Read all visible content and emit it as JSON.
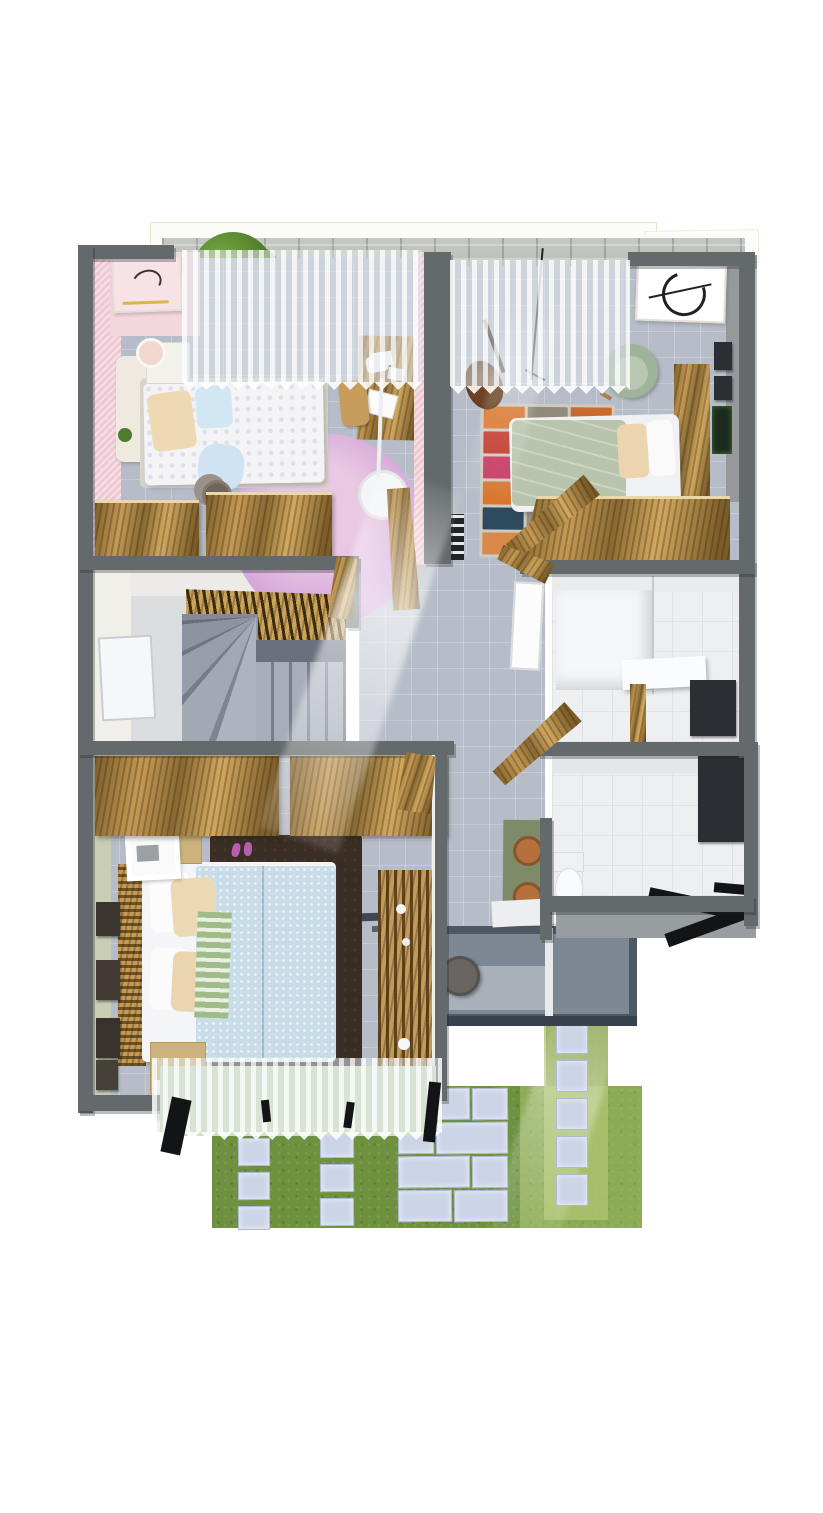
{
  "scene": {
    "kind": "3d-rendered-floor-plan",
    "view": "top-down dollhouse render, upper storey of a house",
    "background": "white",
    "no_visible_text": true
  },
  "palette": {
    "wall_grey": "#646a6c",
    "floor_tile_grey": "#b7bdc8",
    "bathroom_white": "#edeff1",
    "wood_light": "#c59a55",
    "wood_dark": "#7c5d2a",
    "pink_wall": "#eec9d3",
    "purple_rug": "#c79fd6",
    "sage_duvet": "#b9c4ad",
    "master_duvet": "#c9dde9",
    "dark_rug": "#3a2d24",
    "grass_green": "#6e9140",
    "grass_light": "#a9bd6e",
    "paver_grey": "#ccd4e8",
    "brick_grey": "#b4b6b1",
    "deck_slate": "#7e8894",
    "vanity_green": "#7e8b69",
    "copper_sink": "#b5713d",
    "rug_orange": "#d9762f",
    "rug_red": "#c23a2c",
    "rug_blue": "#3e6b82",
    "rug_navy": "#2e4a5e"
  },
  "rooms": [
    {
      "id": "bedroom-pink",
      "label": "Bedroom 1 (pink)",
      "position": "top-left",
      "furniture": [
        "double-bed",
        "headboard-bench",
        "nightstand",
        "table-lamp",
        "round-purple-rug",
        "side-stool-with-hat",
        "desk",
        "desk-chair",
        "laptop",
        "floor-lamp",
        "wardrobe",
        "wall-art-frame",
        "sheer-curtain-window"
      ]
    },
    {
      "id": "bedroom-green",
      "label": "Bedroom 2 (sage)",
      "position": "top-right",
      "furniture": [
        "single-bed",
        "wood-headboard",
        "armchair",
        "guitar",
        "mic-stand",
        "striped-multicolor-rug",
        "wardrobe",
        "circular-wall-art",
        "small-picture-frames",
        "bookshelf",
        "sheer-curtain-window"
      ]
    },
    {
      "id": "staircase",
      "label": "Stair hall",
      "position": "middle-left",
      "furniture": [
        "winder-staircase",
        "straight-flight",
        "wood-slat-screen",
        "whiteboard"
      ]
    },
    {
      "id": "hallway",
      "label": "Hallway / landing",
      "position": "center",
      "furniture": [
        "open-wood-doors",
        "sunbeam",
        "round-pouf",
        "step-edges"
      ]
    },
    {
      "id": "bathroom-shower",
      "label": "Shower bathroom",
      "position": "middle-right",
      "furniture": [
        "walk-in-shower",
        "glass-partition",
        "bench-slab",
        "dark-vanity-panel",
        "wood-trim",
        "leaning-white-panel"
      ]
    },
    {
      "id": "bathroom-wc",
      "label": "WC bathroom",
      "position": "right-lower",
      "furniture": [
        "toilet",
        "green-vanity-wall",
        "copper-basins",
        "counter",
        "dark-mirror-panel",
        "open-dark-doors"
      ]
    },
    {
      "id": "bedroom-master",
      "label": "Master bedroom",
      "position": "bottom-left",
      "furniture": [
        "double-bed",
        "slat-headboard",
        "dark-area-rug",
        "slippers",
        "nightstand-top",
        "white-frame-object",
        "nightstand-bottom",
        "cube-lamp",
        "wood-dresser",
        "wardrobe-band",
        "gallery-frames",
        "sheer-curtain-window"
      ]
    },
    {
      "id": "terrace-deck",
      "label": "Terrace deck",
      "position": "bottom-center",
      "furniture": [
        "slate-deck",
        "white-divider",
        "round-pouf"
      ]
    },
    {
      "id": "garden",
      "label": "Garden / backyard",
      "position": "bottom",
      "furniture": [
        "lawn",
        "paver-tile-columns",
        "large-paver-slabs",
        "light-green-strip"
      ]
    },
    {
      "id": "patio-wall",
      "label": "Rear patio with brick wall",
      "position": "top",
      "furniture": [
        "grey-brick-wall",
        "white-architrave",
        "shrubs-and-plants"
      ]
    }
  ]
}
